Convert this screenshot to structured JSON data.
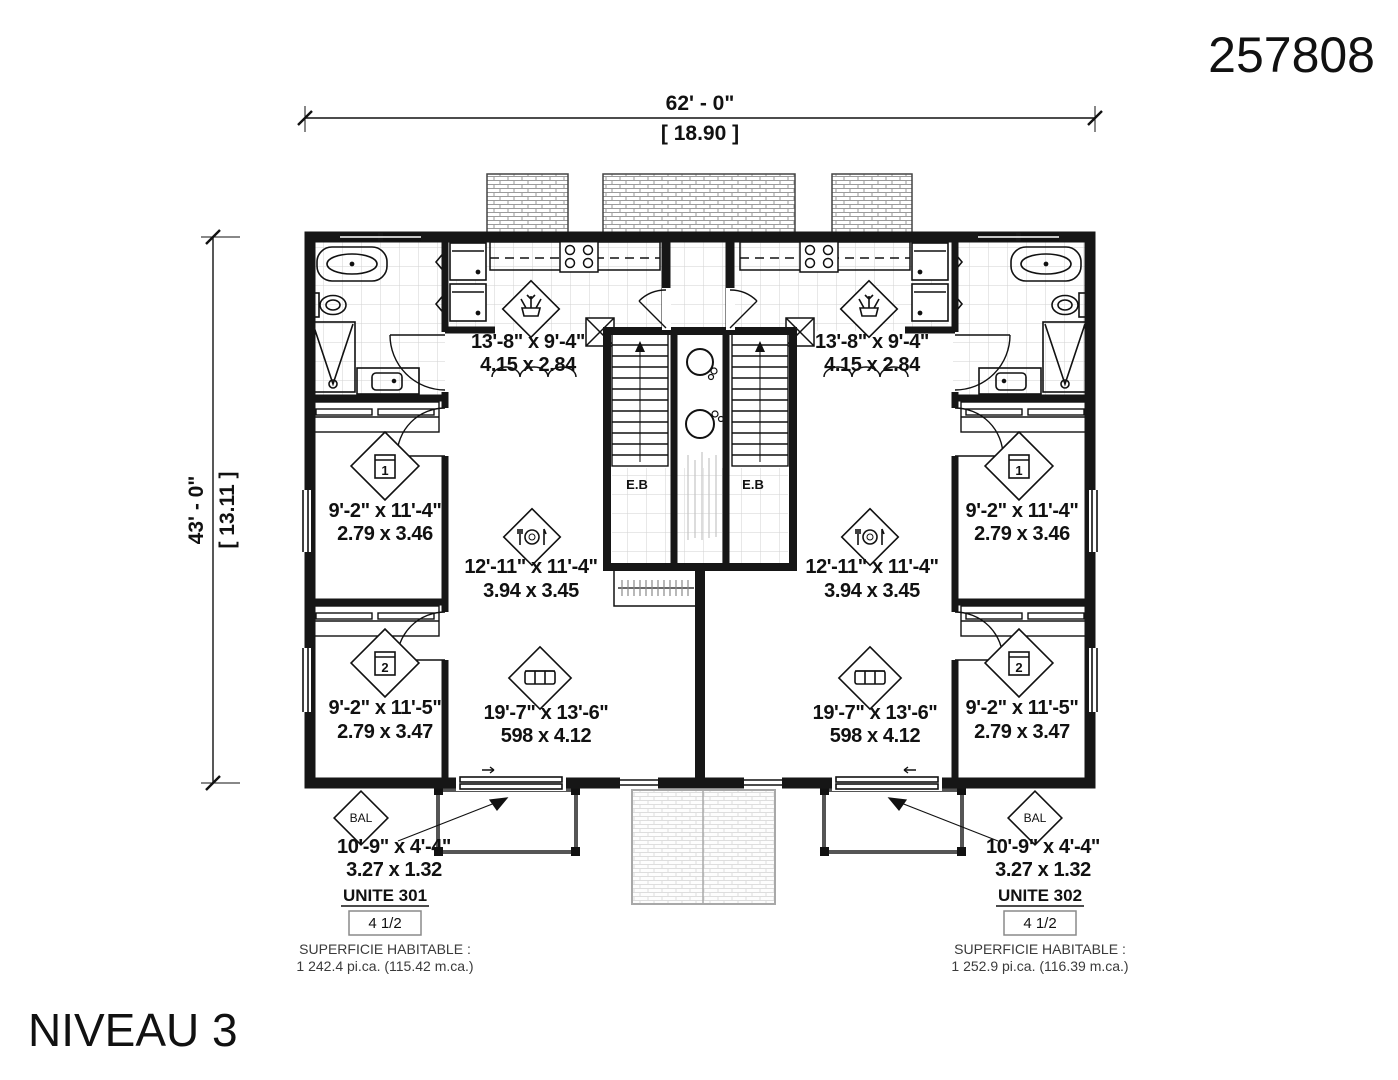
{
  "plan_number": "257808",
  "level_title": "NIVEAU 3",
  "overall_dimensions": {
    "width_imperial": "62' - 0\"",
    "width_metric": "[ 18.90 ]",
    "height_imperial": "43' - 0\"",
    "height_metric": "[ 13.11 ]"
  },
  "units": [
    {
      "name": "UNITE 301",
      "configuration": "4 1/2",
      "area_title": "SUPERFICIE HABITABLE :",
      "area_value": "1 242.4 pi.ca. (115.42 m.ca.)",
      "technical_label": "E.B",
      "rooms": {
        "kitchen": {
          "icon": "plant-icon",
          "imperial": "13'-8\" x 9'-4\"",
          "metric": "4.15 x 2.84"
        },
        "bedroom_1": {
          "icon": "bed-icon",
          "number": "1",
          "imperial": "9'-2\" x 11'-4\"",
          "metric": "2.79 x 3.46"
        },
        "dining": {
          "icon": "dining-icon",
          "imperial": "12'-11\" x 11'-4\"",
          "metric": "3.94 x 3.45"
        },
        "bedroom_2": {
          "icon": "bed-icon",
          "number": "2",
          "imperial": "9'-2\" x 11'-5\"",
          "metric": "2.79 x 3.47"
        },
        "living": {
          "icon": "sofa-icon",
          "imperial": "19'-7\" x 13'-6\"",
          "metric": "598 x 4.12"
        },
        "balcony": {
          "label": "BAL",
          "imperial": "10'-9\" x 4'-4\"",
          "metric": "3.27 x 1.32"
        }
      }
    },
    {
      "name": "UNITE 302",
      "configuration": "4 1/2",
      "area_title": "SUPERFICIE HABITABLE :",
      "area_value": "1 252.9 pi.ca. (116.39 m.ca.)",
      "technical_label": "E.B",
      "rooms": {
        "kitchen": {
          "icon": "plant-icon",
          "imperial": "13'-8\" x 9'-4\"",
          "metric": "4.15 x 2.84"
        },
        "bedroom_1": {
          "icon": "bed-icon",
          "number": "1",
          "imperial": "9'-2\" x 11'-4\"",
          "metric": "2.79 x 3.46"
        },
        "dining": {
          "icon": "dining-icon",
          "imperial": "12'-11\" x 11'-4\"",
          "metric": "3.94 x 3.45"
        },
        "bedroom_2": {
          "icon": "bed-icon",
          "number": "2",
          "imperial": "9'-2\" x 11'-5\"",
          "metric": "2.79 x 3.47"
        },
        "living": {
          "icon": "sofa-icon",
          "imperial": "19'-7\" x 13'-6\"",
          "metric": "598 x 4.12"
        },
        "balcony": {
          "label": "BAL",
          "imperial": "10'-9\" x 4'-4\"",
          "metric": "3.27 x 1.32"
        }
      }
    }
  ],
  "colors": {
    "ink": "#111111",
    "wall": "#161616",
    "grid": "#cfcfcf",
    "hatch": "#9a9a9a",
    "hatch_light": "#d8d8d8",
    "balcony_outline": "#555555"
  }
}
